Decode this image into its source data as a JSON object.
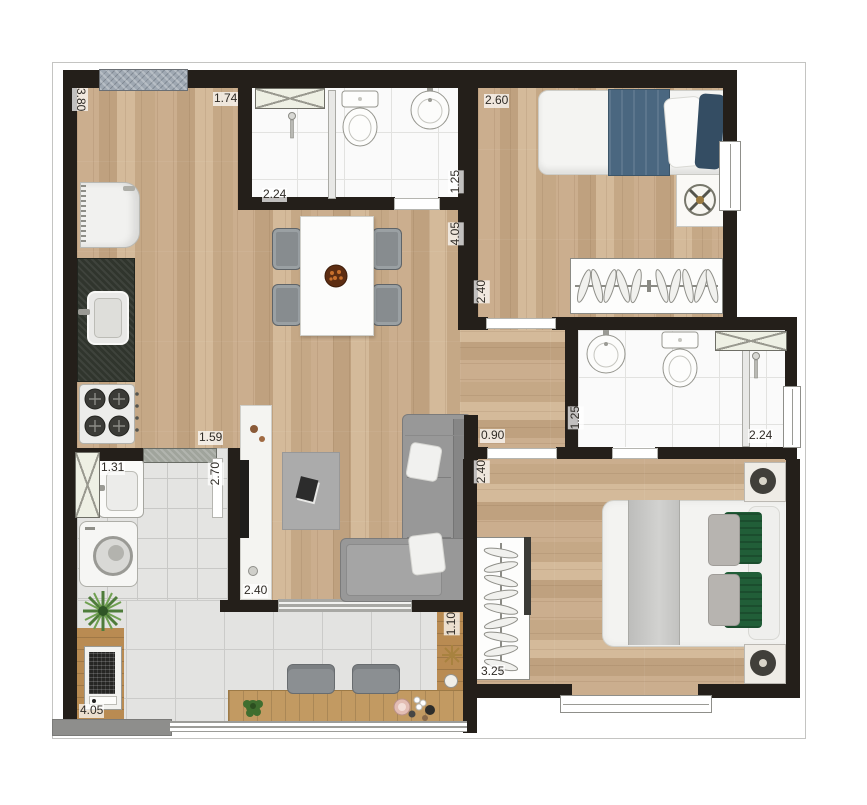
{
  "dims": {
    "living_left": "3.80",
    "entry_width": "1.74",
    "bath1_width": "2.24",
    "bath1_depth": "1.25",
    "bedroom1_width": "2.60",
    "living_right": "4.05",
    "bedroom1_depth": "2.40",
    "kitchen_pass": "1.59",
    "service_depth": "2.70",
    "laundry_tank": "1.31",
    "hall_width": "0.90",
    "bath2_depth": "1.25",
    "bath2_width": "2.24",
    "bedroom2_depth": "2.40",
    "living_balcony": "2.40",
    "bedroom2_width": "3.25",
    "balcony_length": "4.05",
    "balcony_depth": "1.10"
  },
  "colors": {
    "wall": "#241f1a",
    "wood_floor": "#c9ac8b",
    "tile_floor": "#e3e3e1",
    "bed_blanket_blue": "#4a6780",
    "bed_cushion_green": "#215e38",
    "sofa_gray": "#989898"
  }
}
